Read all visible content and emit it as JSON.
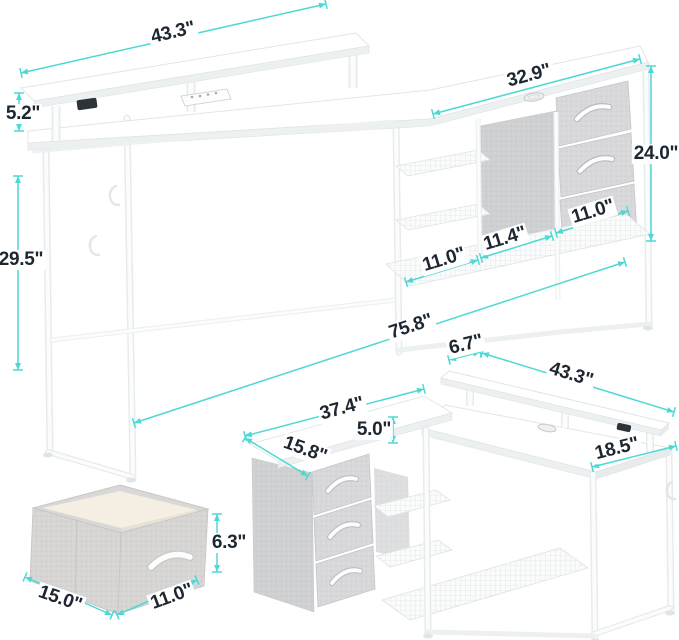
{
  "canvas": {
    "width": 679,
    "height": 640,
    "background": "#ffffff"
  },
  "style": {
    "line_color": "#4ed8d4",
    "text_color": "#1d2731",
    "font_size_px": 19,
    "tick_half": 5,
    "arrow_len": 7,
    "arrow_half": 3
  },
  "views": {
    "linear_desk": {
      "name": "desk-extended-configuration"
    },
    "l_desk": {
      "name": "desk-l-shaped-configuration"
    },
    "storage_bin": {
      "name": "fabric-storage-bin"
    }
  },
  "dimensions": [
    {
      "id": "monitor-shelf-length",
      "part": "linear-desk",
      "label": "43.3\"",
      "cx": 173,
      "cy": 33,
      "rot": -13,
      "x1": 21,
      "y1": 73,
      "x2": 326,
      "y2": 4
    },
    {
      "id": "monitor-shelf-height",
      "part": "linear-desk",
      "label": "5.2\"",
      "cx": 23,
      "cy": 114,
      "rot": 0,
      "x1": 19,
      "y1": 93,
      "x2": 19,
      "y2": 131
    },
    {
      "id": "hutch-top-length",
      "part": "linear-desk",
      "label": "32.9\"",
      "cx": 529,
      "cy": 76,
      "rot": -15,
      "x1": 433,
      "y1": 114,
      "x2": 640,
      "y2": 59
    },
    {
      "id": "hutch-height",
      "part": "linear-desk",
      "label": "24.0\"",
      "cx": 656,
      "cy": 154,
      "rot": 0,
      "x1": 651,
      "y1": 66,
      "x2": 651,
      "y2": 241
    },
    {
      "id": "desk-height",
      "part": "linear-desk",
      "label": "29.5\"",
      "cx": 21,
      "cy": 260,
      "rot": 0,
      "x1": 18,
      "y1": 176,
      "x2": 18,
      "y2": 370
    },
    {
      "id": "shelf-depth-left",
      "part": "linear-desk",
      "label": "11.0\"",
      "cx": 444,
      "cy": 260,
      "rot": -17,
      "x1": 406,
      "y1": 282,
      "x2": 478,
      "y2": 260
    },
    {
      "id": "shelf-depth-middle",
      "part": "linear-desk",
      "label": "11.4\"",
      "cx": 505,
      "cy": 239,
      "rot": -17,
      "x1": 481,
      "y1": 258,
      "x2": 552,
      "y2": 236
    },
    {
      "id": "shelf-depth-right",
      "part": "linear-desk",
      "label": "11.0\"",
      "cx": 593,
      "cy": 212,
      "rot": -17,
      "x1": 556,
      "y1": 233,
      "x2": 628,
      "y2": 211
    },
    {
      "id": "total-length",
      "part": "linear-desk",
      "label": "75.8\"",
      "cx": 411,
      "cy": 327,
      "rot": -18,
      "x1": 134,
      "y1": 423,
      "x2": 625,
      "y2": 262
    },
    {
      "id": "l-shelf-depth",
      "part": "l-desk",
      "label": "6.7\"",
      "cx": 466,
      "cy": 345,
      "rot": -14,
      "x1": 449,
      "y1": 360,
      "x2": 480,
      "y2": 352
    },
    {
      "id": "l-right-length",
      "part": "l-desk",
      "label": "43.3\"",
      "cx": 571,
      "cy": 375,
      "rot": 17,
      "x1": 482,
      "y1": 353,
      "x2": 674,
      "y2": 412
    },
    {
      "id": "l-left-length",
      "part": "l-desk",
      "label": "37.4\"",
      "cx": 342,
      "cy": 409,
      "rot": -15,
      "x1": 245,
      "y1": 436,
      "x2": 424,
      "y2": 389
    },
    {
      "id": "l-shelf-rise",
      "part": "l-desk",
      "label": "5.0\"",
      "cx": 374,
      "cy": 430,
      "rot": 0,
      "x1": 393,
      "y1": 417,
      "x2": 393,
      "y2": 443
    },
    {
      "id": "l-left-depth",
      "part": "l-desk",
      "label": "15.8\"",
      "cx": 305,
      "cy": 450,
      "rot": 20,
      "x1": 245,
      "y1": 438,
      "x2": 308,
      "y2": 476
    },
    {
      "id": "l-right-depth",
      "part": "l-desk",
      "label": "18.5\"",
      "cx": 617,
      "cy": 449,
      "rot": -14,
      "x1": 592,
      "y1": 467,
      "x2": 676,
      "y2": 446
    },
    {
      "id": "bin-height",
      "part": "storage-bin",
      "label": "6.3\"",
      "cx": 229,
      "cy": 543,
      "rot": 0,
      "x1": 217,
      "y1": 514,
      "x2": 217,
      "y2": 572
    },
    {
      "id": "bin-length",
      "part": "storage-bin",
      "label": "15.0\"",
      "cx": 60,
      "cy": 599,
      "rot": 19,
      "x1": 25,
      "y1": 577,
      "x2": 112,
      "y2": 615
    },
    {
      "id": "bin-depth",
      "part": "storage-bin",
      "label": "11.0\"",
      "cx": 172,
      "cy": 597,
      "rot": -20,
      "x1": 117,
      "y1": 615,
      "x2": 197,
      "y2": 580
    }
  ]
}
